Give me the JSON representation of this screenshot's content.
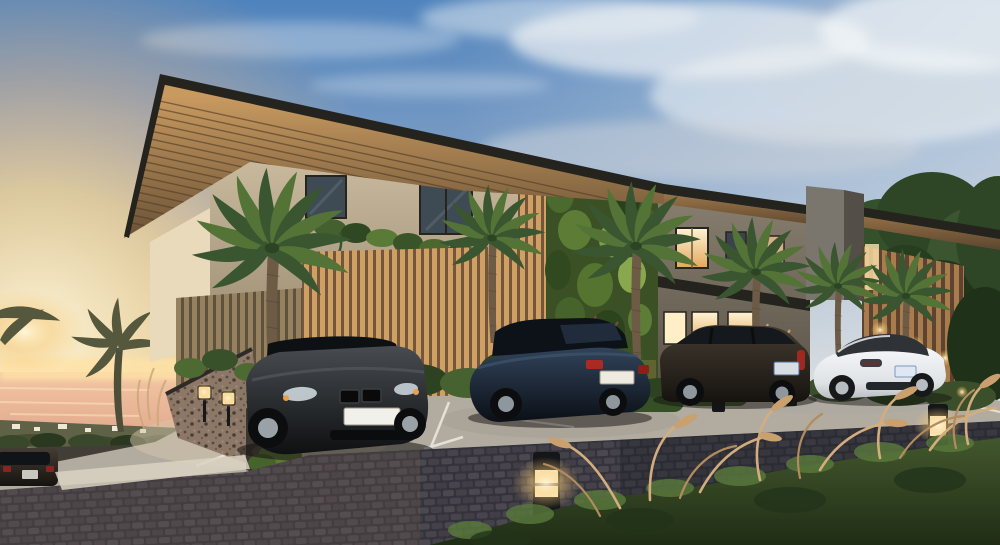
{
  "scene": {
    "type": "exterior architectural rendering",
    "setting": "modern two-storey apartment residence at sunset beside the ocean",
    "elements": [
      "cantilevered flat roof with timber slat soffit",
      "two-storey living green wall",
      "vertical timber slat screens",
      "palm trees",
      "lava stone wall with cube lights",
      "parking bay with painted stalls",
      "bollard path lights",
      "cobblestone driveway",
      "ornamental fountain grasses",
      "sunset glow over the sea with distant shoreline"
    ],
    "cars": [
      {
        "name": "black-sedan-front",
        "color": "#16181b"
      },
      {
        "name": "dark-blue-sedan-rear",
        "color": "#121a24"
      },
      {
        "name": "dark-suv-side",
        "color": "#262019"
      },
      {
        "name": "white-coupe-rear",
        "color": "#eaedf0"
      },
      {
        "name": "dark-wagon-lower-road",
        "color": "#1d2023"
      }
    ],
    "lighting": {
      "time_of_day": "dusk",
      "bollard_count": 4,
      "cube_wall_lights": 2,
      "window_glow": "warm"
    }
  },
  "palette": {
    "sky_top": "#4f83bd",
    "sky_mid": "#93abc7",
    "sky_low": "#d9dcd8",
    "haze": "#eceef0",
    "cloud": "#eef1f4",
    "sun_core": "#fff6d8",
    "sun_gold": "#ffd88e",
    "sun_amber": "#f6b97c",
    "ocean_top": "#f2c6a4",
    "ocean_low": "#e0a58a",
    "horizon_glow": "#ffe2a6",
    "shore_dark": "#5f6247",
    "shore_building": "#efe8d6",
    "roof": "#25231e",
    "soffit_light": "#c89a60",
    "soffit_dark": "#6b5236",
    "wall_light": "#cbbb9f",
    "wall_dark": "#97886f",
    "wall_cream": "#e9dabb",
    "green_wall": "#3b5125",
    "green_wall_light": "#7f9d4b",
    "wing_wall": "#877e6f",
    "wing_wall_dark": "#524b40",
    "parapet": "#7b766d",
    "parapet_side": "#534f48",
    "slat_light": "#cf9f63",
    "slat_gap": "#74573b",
    "slat_shaded": "#95815f",
    "slat_shaded_gap": "#60513c",
    "slat_right": "#a87c4c",
    "slat_right_gap": "#5e4430",
    "window_lit": "#ffeec6",
    "window_glass": "#3e4a54",
    "stone": "#8d7868",
    "stone_shadow": "#3c3631",
    "concrete": "#b2aca0",
    "concrete_warm": "#d3c5ab",
    "stall_line": "#eae7de",
    "cobble": "#34333b",
    "cobble_stone": "#4b4850",
    "cobble_warm": "#7a6450",
    "hedge": "#42572d",
    "hedge_dark": "#202d15",
    "grass_plume": "#d4ad7e",
    "palm_green": "#3a5630",
    "palm_green_light": "#547336",
    "palm_trunk": "#6d5b45",
    "car_black": "#16181b",
    "car_blue": "#121a24",
    "car_suv": "#262019",
    "car_white": "#eaedf0",
    "car_wagon": "#1d2023",
    "bollard": "#151619",
    "glow": "#ffeebb",
    "shadow": "#141210"
  }
}
